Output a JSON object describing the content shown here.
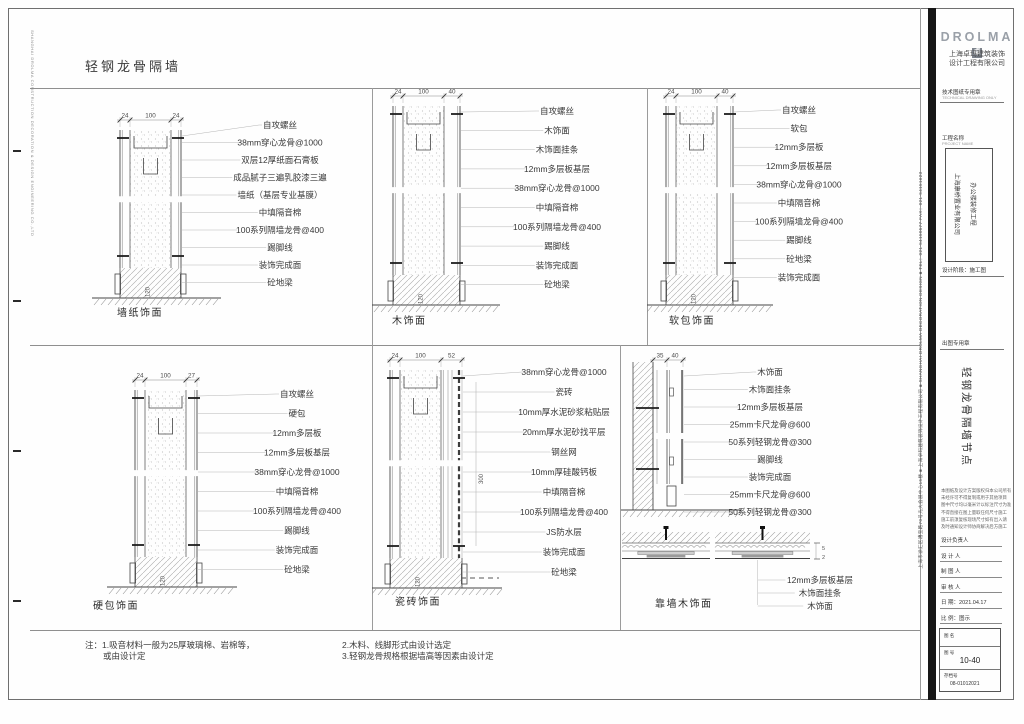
{
  "page": {
    "title": "轻钢龙骨隔墙",
    "contact_vertical": "上海市徐汇区漕宝路70号光大会展中心15楼 ■ 上海卓玛建筑装饰设计工程有限公司 ■ SHANGHAI DROLMA DECORATION DESIGN ■ TEL：021-54150577 FAX：021-54151623",
    "left_margin_vertical": "SHANGHAI DROLMA CONSTRUCTION DECORATION & DESIGN ENGINEERING CO.,LTD"
  },
  "details": [
    {
      "caption": "墙纸饰面",
      "dims": [
        "24",
        "100",
        "24"
      ],
      "base_dim": "120",
      "labels": [
        "自攻螺丝",
        "38mm穿心龙骨@1000",
        "双层12厚纸面石膏板",
        "成品腻子三遍乳胶漆三遍",
        "墙纸（基层专业基膜）",
        "中填隔音棉",
        "100系列隔墙龙骨@400",
        "踢脚线",
        "装饰完成面",
        "砼地梁"
      ]
    },
    {
      "caption": "木饰面",
      "dims": [
        "24",
        "100",
        "40"
      ],
      "base_dim": "120",
      "labels": [
        "自攻螺丝",
        "木饰面",
        "木饰面挂条",
        "12mm多层板基层",
        "38mm穿心龙骨@1000",
        "中填隔音棉",
        "100系列隔墙龙骨@400",
        "踢脚线",
        "装饰完成面",
        "砼地梁"
      ]
    },
    {
      "caption": "软包饰面",
      "dims": [
        "24",
        "100",
        "40"
      ],
      "base_dim": "120",
      "labels": [
        "自攻螺丝",
        "软包",
        "12mm多层板",
        "12mm多层板基层",
        "38mm穿心龙骨@1000",
        "中填隔音棉",
        "100系列隔墙龙骨@400",
        "踢脚线",
        "砼地梁",
        "装饰完成面"
      ]
    },
    {
      "caption": "硬包饰面",
      "dims": [
        "24",
        "100",
        "27"
      ],
      "base_dim": "120",
      "labels": [
        "自攻螺丝",
        "硬包",
        "12mm多层板",
        "12mm多层板基层",
        "38mm穿心龙骨@1000",
        "中填隔音棉",
        "100系列隔墙龙骨@400",
        "踢脚线",
        "装饰完成面",
        "砼地梁"
      ]
    },
    {
      "caption": "瓷砖饰面",
      "dims": [
        "24",
        "100",
        "52"
      ],
      "base_dim": "120",
      "side_dim": "300",
      "labels": [
        "38mm穿心龙骨@1000",
        "瓷砖",
        "10mm厚水泥砂浆粘贴层",
        "20mm厚水泥砂找平层",
        "钢丝网",
        "10mm厚硅酸钙板",
        "中填隔音棉",
        "100系列隔墙龙骨@400",
        "JS防水层",
        "装饰完成面",
        "砼地梁"
      ]
    },
    {
      "caption": "靠墙木饰面",
      "dims": [
        "35",
        "40"
      ],
      "plan_dims": [
        "5",
        "2"
      ],
      "labels": [
        "木饰面",
        "木饰面挂条",
        "12mm多层板基层",
        "25mm卡尺龙骨@600",
        "50系列轻钢龙骨@300",
        "踢脚线",
        "装饰完成面",
        "25mm卡尺龙骨@600",
        "50系列轻钢龙骨@300"
      ],
      "bottom_labels": [
        "12mm多层板基层",
        "木饰面挂条",
        "木饰面"
      ]
    }
  ],
  "notes": {
    "col1": [
      "注：1.吸音材料一般为25厚玻璃棉、岩棉等，",
      "或由设计定"
    ],
    "col2": [
      "2.木料、线脚形式由设计选定",
      "3.轻钢龙骨规格根据墙高等因素由设计定"
    ]
  },
  "titleblock": {
    "logo": "DROLMA",
    "logo_mark": "卓",
    "company": [
      "上海卓玛建筑装饰",
      "设计工程有限公司"
    ],
    "stamp1": "技术图纸专用章",
    "stamp1_sub": "TECHNICAL DRAWING ONLY",
    "project_label": "工程名称",
    "project_label_sub": "PROJECT NAME",
    "project_cols": [
      "上海康桥置业有限公司",
      "办公楼装修工程"
    ],
    "stage_label": "设计阶段：施工图",
    "stamp2_label": "出图专用章",
    "sheet_title": "轻钢龙骨隔墙节点",
    "disclaimer": [
      "本图纸及设计方案版权归本公司所有",
      "未经许可不得复制或用于其他项目",
      "图中尺寸均以毫米计以标注尺寸为准",
      "不得直接在图上量取任何尺寸施工",
      "施工前须复核现场尺寸如有出入请",
      "及时通知设计师协商解决后方施工"
    ],
    "fields": [
      {
        "label": "设计负责人",
        "value": ""
      },
      {
        "label": "设 计 人",
        "value": ""
      },
      {
        "label": "制 图 人",
        "value": ""
      },
      {
        "label": "审 核 人",
        "value": ""
      },
      {
        "label": "日  期",
        "value": "2021.04.17"
      },
      {
        "label": "比  例",
        "value": "图示"
      }
    ],
    "sheet_box": {
      "name_label": "图 名",
      "no_label": "图 号",
      "number": "10-40",
      "archive_label": "存档号",
      "archive_no": "08-01012021"
    }
  }
}
